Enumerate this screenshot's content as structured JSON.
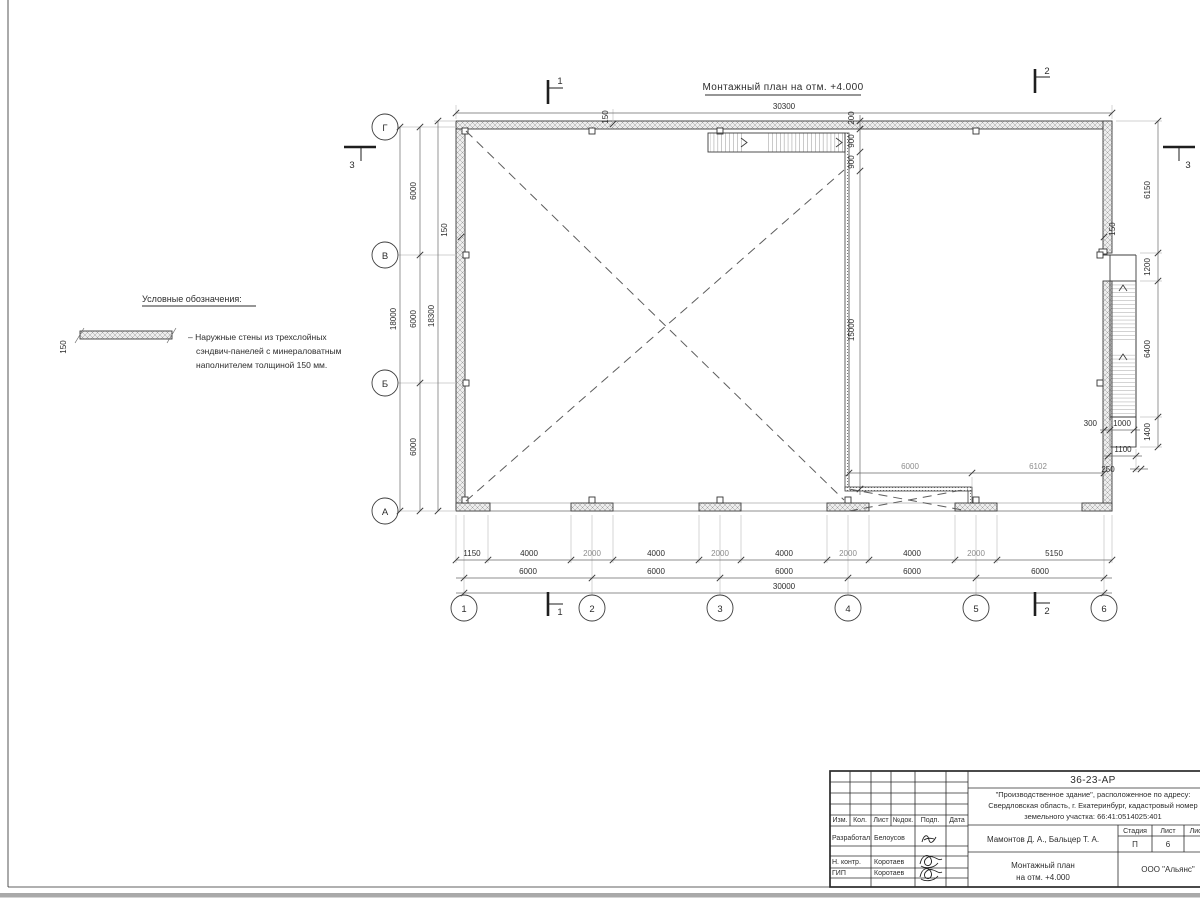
{
  "drawing_title": "Монтажный план на отм. +4.000",
  "legend": {
    "title": "Условные обозначения:",
    "symbol_thickness": "150",
    "item_line1": "– Наружные стены из трехслойных",
    "item_line2": "сэндвич-панелей с минераловатным",
    "item_line3": "наполнителем толщиной 150 мм."
  },
  "axes": {
    "cols": [
      "1",
      "2",
      "3",
      "4",
      "5",
      "6"
    ],
    "rows": [
      "Г",
      "В",
      "Б",
      "А"
    ]
  },
  "section_marks": {
    "m1": "1",
    "m2": "2",
    "m3": "3"
  },
  "dims": {
    "top_total": "30300",
    "wall_thk": "150",
    "stair_top": [
      "200",
      "900",
      "900"
    ],
    "interior_wall_len": "15000",
    "interior_bottom": [
      "6000",
      "6102"
    ],
    "right_segments": [
      "6150",
      "1200",
      "6400",
      "1400"
    ],
    "stair_right": {
      "offset": "300",
      "width": "1000",
      "landing": "1100",
      "gap": "250"
    },
    "bottom_row1": [
      "1150",
      "4000",
      "2000",
      "4000",
      "2000",
      "4000",
      "2000",
      "4000",
      "2000",
      "5150"
    ],
    "bottom_row2": [
      "6000",
      "6000",
      "6000",
      "6000",
      "6000"
    ],
    "bottom_total": "30000",
    "left_rows": [
      "6000",
      "6000",
      "6000"
    ],
    "left_total": "18000",
    "left_overall": "18300"
  },
  "title_block": {
    "code": "36-23-АР",
    "project_line1": "\"Производственное здание\", расположенное по адресу:",
    "project_line2": "Свердловская область, г. Екатеринбург, кадастровый номер",
    "project_line3": "земельного участка: 66:41:0514025:401",
    "col_headers": [
      "Изм.",
      "Кол.",
      "Лист",
      "№док.",
      "Подп.",
      "Дата"
    ],
    "row1_role": "Разработал",
    "row1_name": "Белоусов",
    "row2_role": "Н. контр.",
    "row2_name": "Коротаев",
    "row3_role": "ГИП",
    "row3_name": "Коротаев",
    "authors": "Мамонтов Д. А., Бальцер Т. А.",
    "stage_header": [
      "Стадия",
      "Лист",
      "Листов"
    ],
    "stage_value": "П",
    "sheet_value": "6",
    "drawing_line1": "Монтажный план",
    "drawing_line2": "на отм. +4.000",
    "company": "ООО \"Альянс\""
  }
}
